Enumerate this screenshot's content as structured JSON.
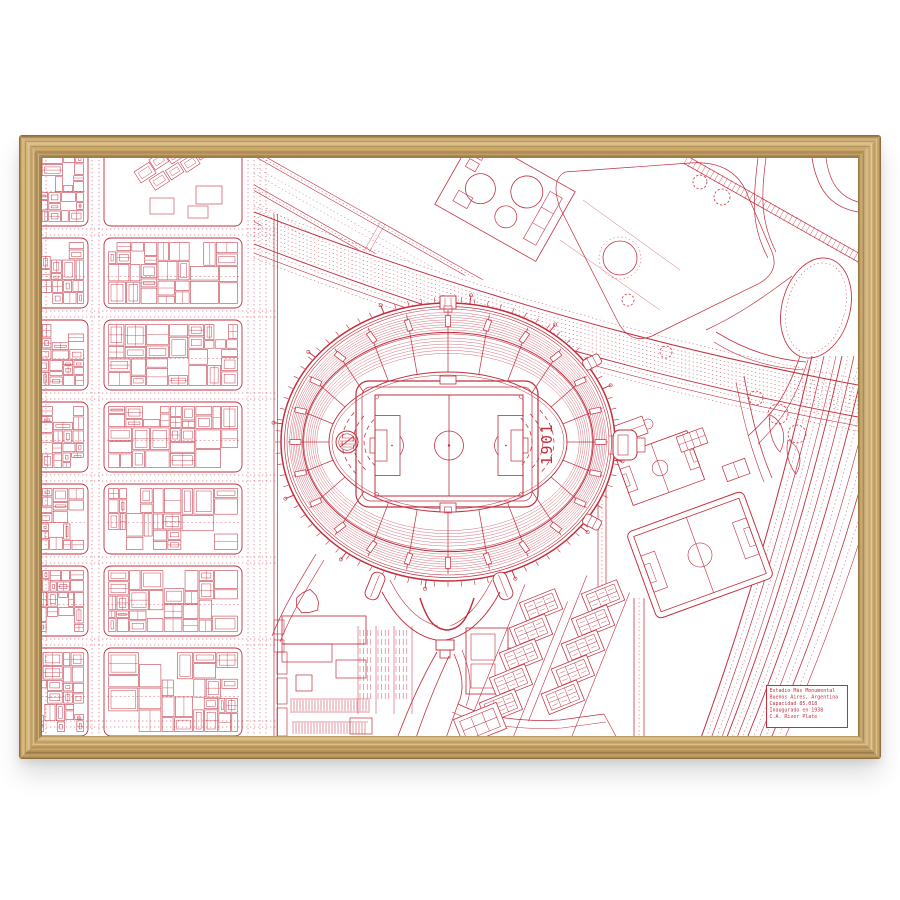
{
  "artwork": {
    "kind": "framed red line-art stadium map print",
    "orientation": "landscape"
  },
  "frame": {
    "material": "oak",
    "wood_light": "#d9bc83",
    "wood_mid": "#c7a365",
    "wood_dark": "#a8854f",
    "wood_edge": "#8f6f42"
  },
  "print": {
    "background": "#ffffff",
    "ink": "#c22e3e"
  },
  "stadium": {
    "year_mark": "1901",
    "badge": "club-crest-circle"
  },
  "plate": {
    "lines": [
      "Estadio Más Monumental",
      "Buenos Aires, Argentina",
      "Capacidad 85.018",
      "Inaugurado en 1938",
      "C.A. River Plate"
    ]
  }
}
